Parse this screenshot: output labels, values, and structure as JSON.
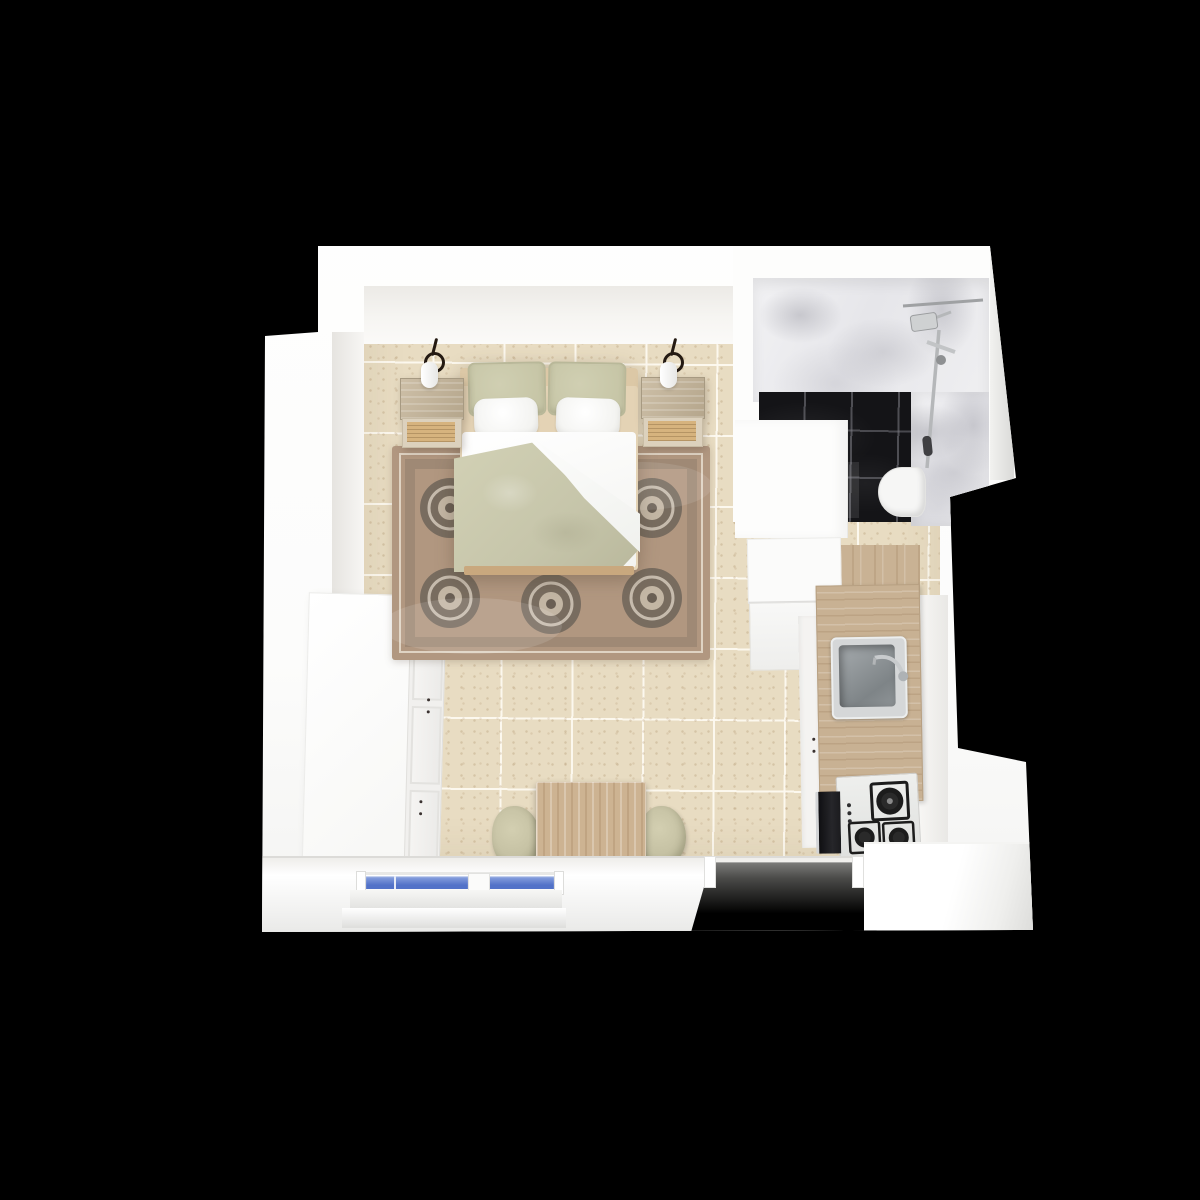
{
  "scene": {
    "title": "3D top-down floor plan render of a studio apartment on a black background",
    "view": "top-down 3D render",
    "background": "black"
  },
  "labels": {
    "scene": "Studio apartment 3D floor plan",
    "bedroom": "Bedroom area with double bed, rug, nightstands and wall sconces",
    "bathroom": "Bathroom with white marble walls, black marble tile floor, shower and toilet",
    "kitchen": "Kitchen run with refrigerator, sink, gas cooktop and oven",
    "dresser": "White chest of drawers",
    "dining": "Wooden dining table with two upholstered chairs",
    "windows": "Bottom wall with two blue-glazed windows",
    "entry": "Entry doorway opening in bottom wall"
  },
  "rooms": [
    {
      "name": "bedroom-living",
      "floor": "beige speckled ceramic tile with white grout",
      "furniture": [
        "double bed with white duvet and sage throw",
        "2 sage pillows",
        "2 white pillows",
        "2 wooden nightstands with rattan drawers",
        "2 black wall sconces with white shades",
        "ornate brown/taupe area rug",
        "white dresser with drawer knobs",
        "square wooden dining table",
        "2 sage upholstered chairs"
      ]
    },
    {
      "name": "bathroom",
      "floor": "black marble tile",
      "walls": "white marble",
      "fixtures": [
        "rain shower head with vertical rail and hand shower",
        "white toilet"
      ]
    },
    {
      "name": "kitchen",
      "floor": "light oak wood",
      "fixtures": [
        "white refrigerator",
        "oak countertop",
        "grey inset sink with chrome faucet",
        "white gas cooktop with 3 black burners and 3 control knobs",
        "black oven with chrome handle",
        "white base cabinets with dark knobs"
      ]
    }
  ],
  "openings": [
    {
      "name": "entry-doorway",
      "wall": "bottom",
      "state": "open"
    },
    {
      "name": "window",
      "wall": "bottom",
      "panes": 2,
      "glass": "blue"
    }
  ],
  "counts": {
    "sconces": 2,
    "nightstands": 2,
    "chairs": 2,
    "burners": 3,
    "window_panes": 2,
    "dresser_drawers": 3
  },
  "colors": {
    "bg": "#000000",
    "wall": "#ffffff",
    "floorTile": "#e8dcc2",
    "rugBase": "#b19780",
    "rugDark": "#6f6459",
    "rugLight": "#ddd3c4",
    "sage": "#c7c6a7",
    "sageBlanket": "#c6c5aa",
    "headboardTan": "#dcc8a6",
    "bedFrame": "#c9a87e",
    "woodCounter": "#c8b193",
    "woodFloor": "#c9b294",
    "woodTable": "#cdb392",
    "rattan": "#d6b37e",
    "marble": "#ebebed",
    "tileBlack": "#141417",
    "chrome": "#b9bbbd",
    "sinkGray": "#8d9396",
    "fridgeWhite": "#fbfbfa",
    "windowBlue": "#5272c8",
    "windowBlueLight": "#8ea6e0",
    "chairSage": "#c0bc9e",
    "knobDark": "#3a3230",
    "sconceBlack": "#241a12"
  }
}
